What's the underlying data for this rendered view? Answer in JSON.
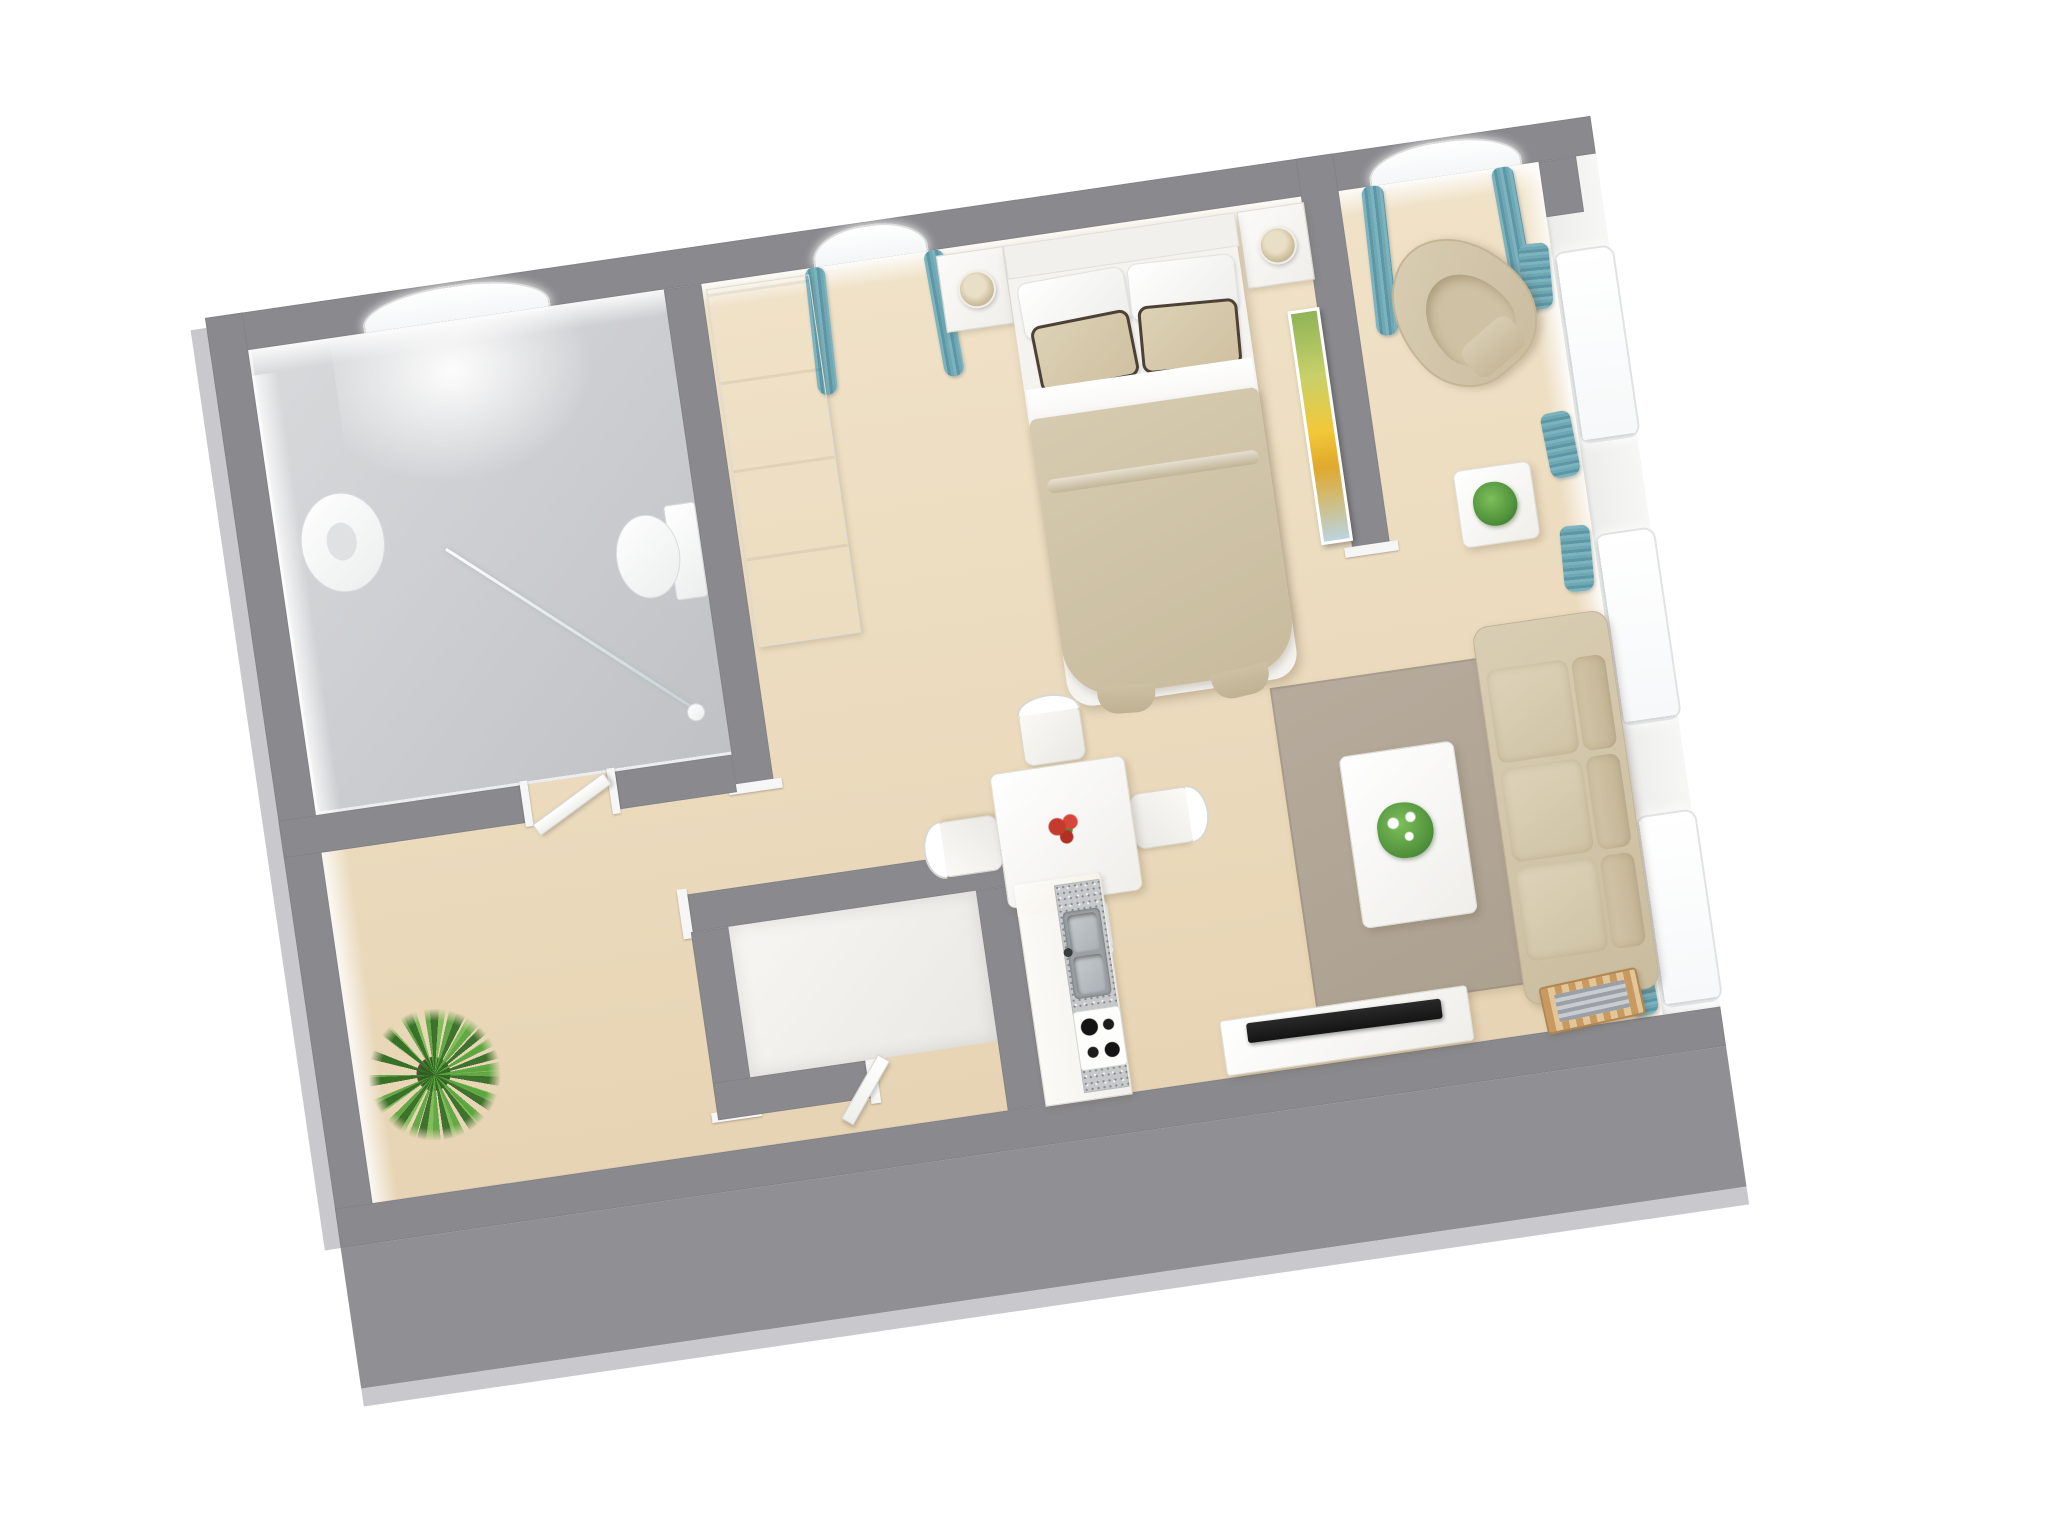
{
  "meta": {
    "description": "3D rendered top-down floor plan of a studio apartment, rotated slightly counter-clockwise on a white background",
    "rotation_deg": -8.3,
    "no_visible_text": true
  },
  "palette": {
    "wallGray": "#8a8a8e",
    "extGray": "#909094",
    "bevel": "#c9c9cd",
    "wood": "#f0e2c8",
    "woodDark": "#e7d4b4",
    "tile": "#c0c1c5",
    "tileLight": "#d9dadc",
    "teal": "#5d97a5",
    "tealLight": "#7db3bf",
    "beige": "#d9cdb3",
    "beigeDark": "#cabc9e",
    "duvet": "#d6cab0",
    "trim": "#4d4136",
    "rug": "#b6ab9c",
    "plant": "#4e8f3a",
    "sunflower": "#f2c838",
    "flowerRed": "#c43a2c",
    "counterTop": "#c6c8ca",
    "rackWood": "#c89a62",
    "tv": "#141414"
  },
  "rooms": {
    "bathroom": {
      "label": "Bathroom",
      "items": [
        "skylight window",
        "washbasin",
        "toilet",
        "glass shower screen",
        "tiled floor",
        "door"
      ]
    },
    "bedroom": {
      "label": "Bedroom area",
      "items": [
        "wardrobe",
        "arched window with teal curtains",
        "nightstand with lamp x2",
        "double bed",
        "white pillows x2",
        "beige trimmed pillows x2",
        "beige duvet",
        "sunflower painting on divider wall"
      ]
    },
    "living": {
      "label": "Living area",
      "items": [
        "tub armchair",
        "side table with plant",
        "taupe rug",
        "coffee table with white-flower plant",
        "three-seat beige sofa",
        "magazine rack",
        "TV bench with flat TV",
        "arched windows with teal curtains x4"
      ]
    },
    "dining": {
      "label": "Dining corner",
      "items": [
        "white square table",
        "red flower centerpiece",
        "white cross-back chairs x4"
      ]
    },
    "kitchen": {
      "label": "Kitchenette",
      "items": [
        "white cabinet run",
        "speckled gray countertop",
        "double stainless sink",
        "gas hob",
        "storage closet"
      ]
    },
    "hallway": {
      "label": "Entry hall",
      "items": [
        "potted palm plant",
        "open white doors"
      ]
    }
  },
  "counts": {
    "arched_side_windows": 3,
    "top_wall_windows": 3,
    "dining_chairs": 4,
    "sofa_seats": 3
  }
}
